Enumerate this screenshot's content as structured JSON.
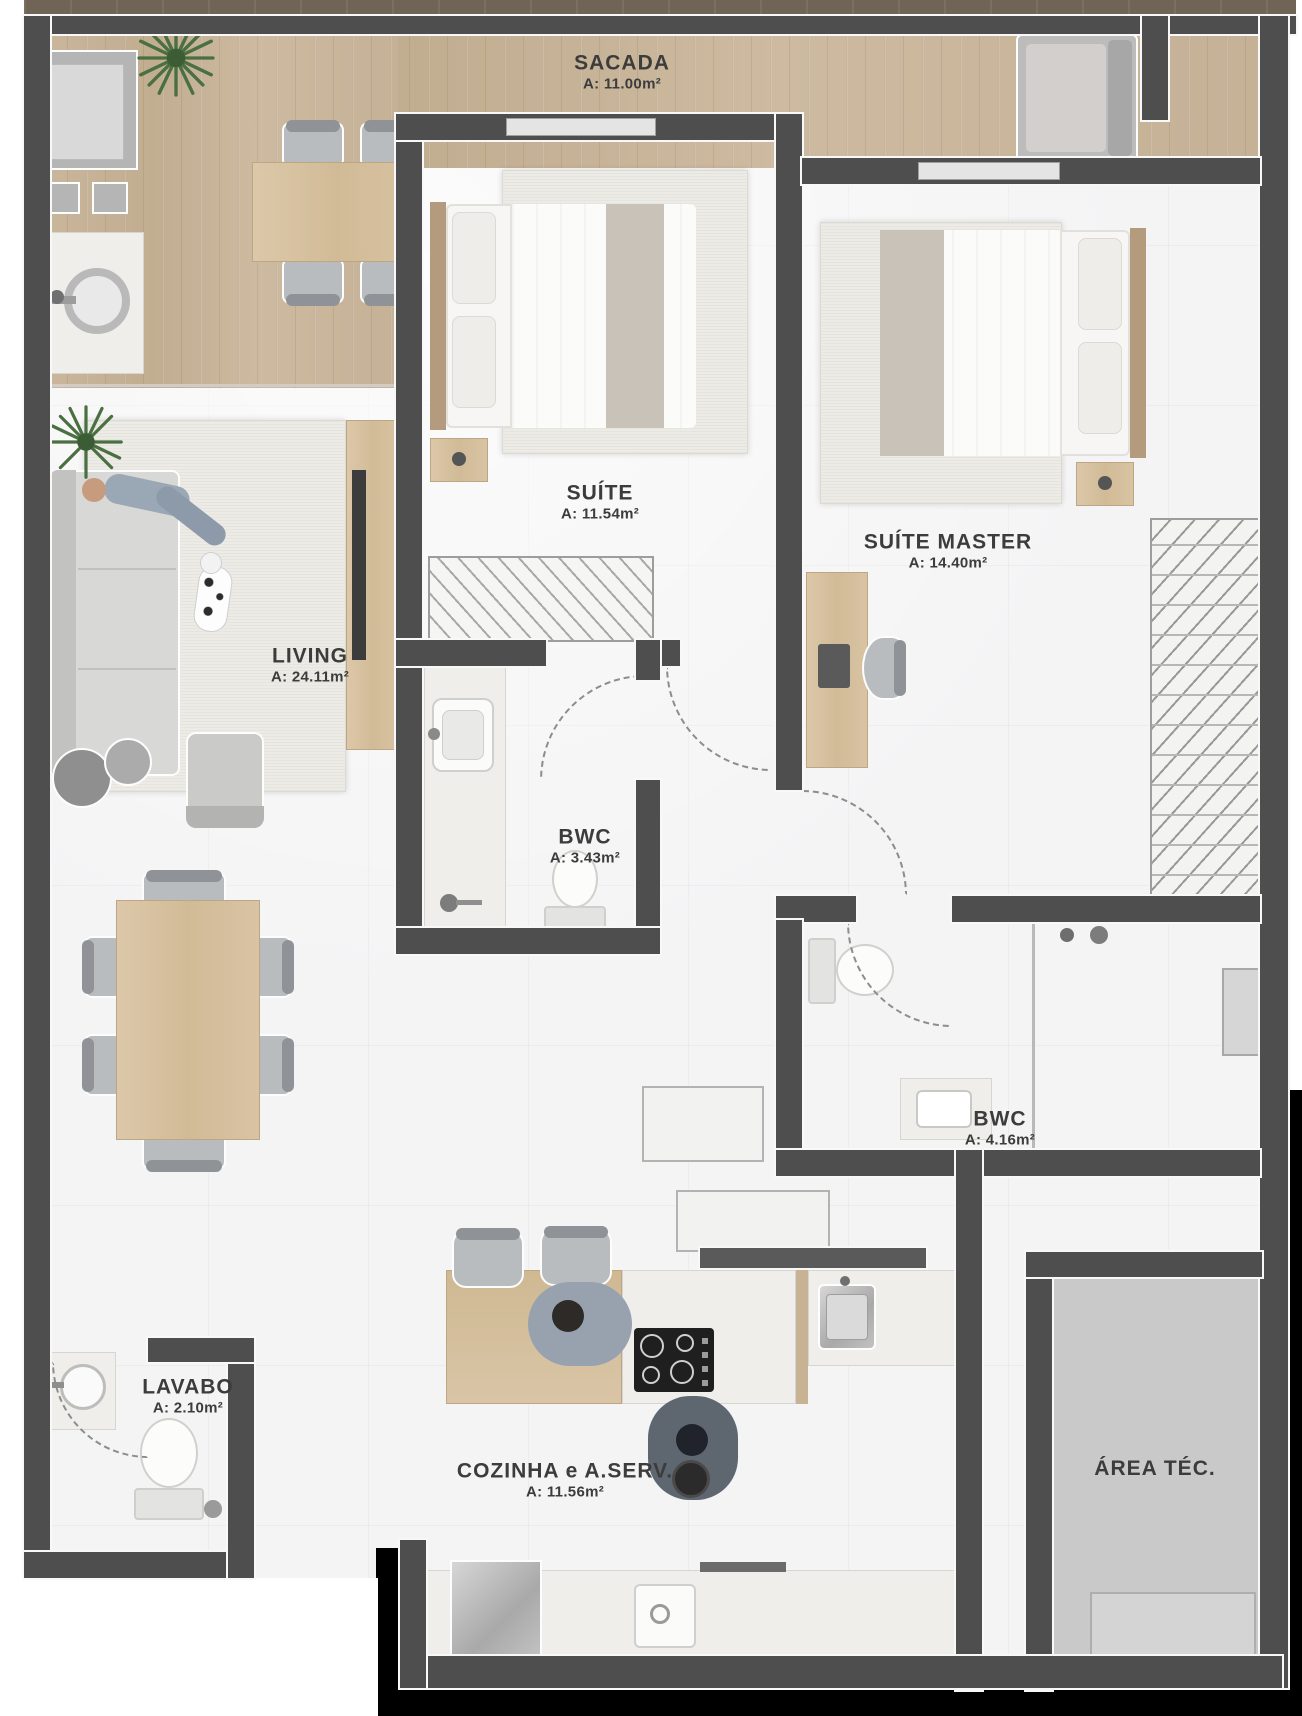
{
  "rooms": {
    "sacada": {
      "name": "SACADA",
      "area": "A: 11.00m²"
    },
    "suite": {
      "name": "SUÍTE",
      "area": "A: 11.54m²"
    },
    "suite_master": {
      "name": "SUÍTE MASTER",
      "area": "A: 14.40m²"
    },
    "living": {
      "name": "LIVING",
      "area": "A: 24.11m²"
    },
    "bwc_suite": {
      "name": "BWC",
      "area": "A: 3.43m²"
    },
    "bwc_master": {
      "name": "BWC",
      "area": "A: 4.16m²"
    },
    "lavabo": {
      "name": "LAVABO",
      "area": "A: 2.10m²"
    },
    "cozinha": {
      "name": "COZINHA e A.SERV.",
      "area": "A: 11.56m²"
    },
    "area_tec": {
      "name": "ÁREA TÉC.",
      "area": ""
    }
  },
  "colors": {
    "wall": "#4e4e4e",
    "wood_floor": "#c8b499",
    "tile_floor": "#f4f4f5",
    "area_tec_floor": "#c9c9c9",
    "outside_bottom": "#000000",
    "plant_green": "#4a7042",
    "label_text": "#3c3c3c"
  }
}
